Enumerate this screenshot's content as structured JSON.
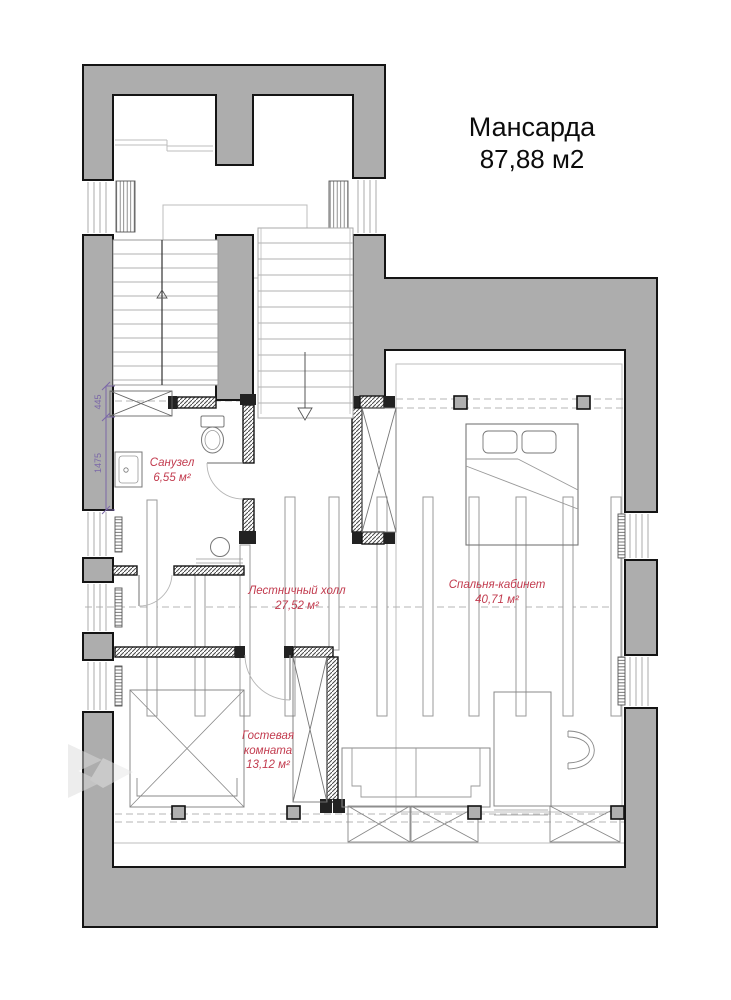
{
  "title": {
    "name": "Мансарда",
    "area": "87,88 м2"
  },
  "rooms": [
    {
      "id": "bathroom",
      "name": "Санузел",
      "area": "6,55 м²"
    },
    {
      "id": "stair-hall",
      "name": "Лестничный холл",
      "area": "27,52 м²"
    },
    {
      "id": "bedroom-office",
      "name": "Спальня-кабинет",
      "area": "40,71 м²"
    },
    {
      "id": "guest-room",
      "name": "Гостевая комната",
      "area": "13,12 м²"
    }
  ],
  "dimensions": {
    "d1": "445",
    "d2": "1475"
  },
  "colors": {
    "wall_fill": "#adadad",
    "wall_outline": "#141414",
    "room_label": "#c23b4e",
    "dimension": "#7b68a8",
    "thin_line": "#b5b5b5",
    "fixture_line": "#888888"
  }
}
